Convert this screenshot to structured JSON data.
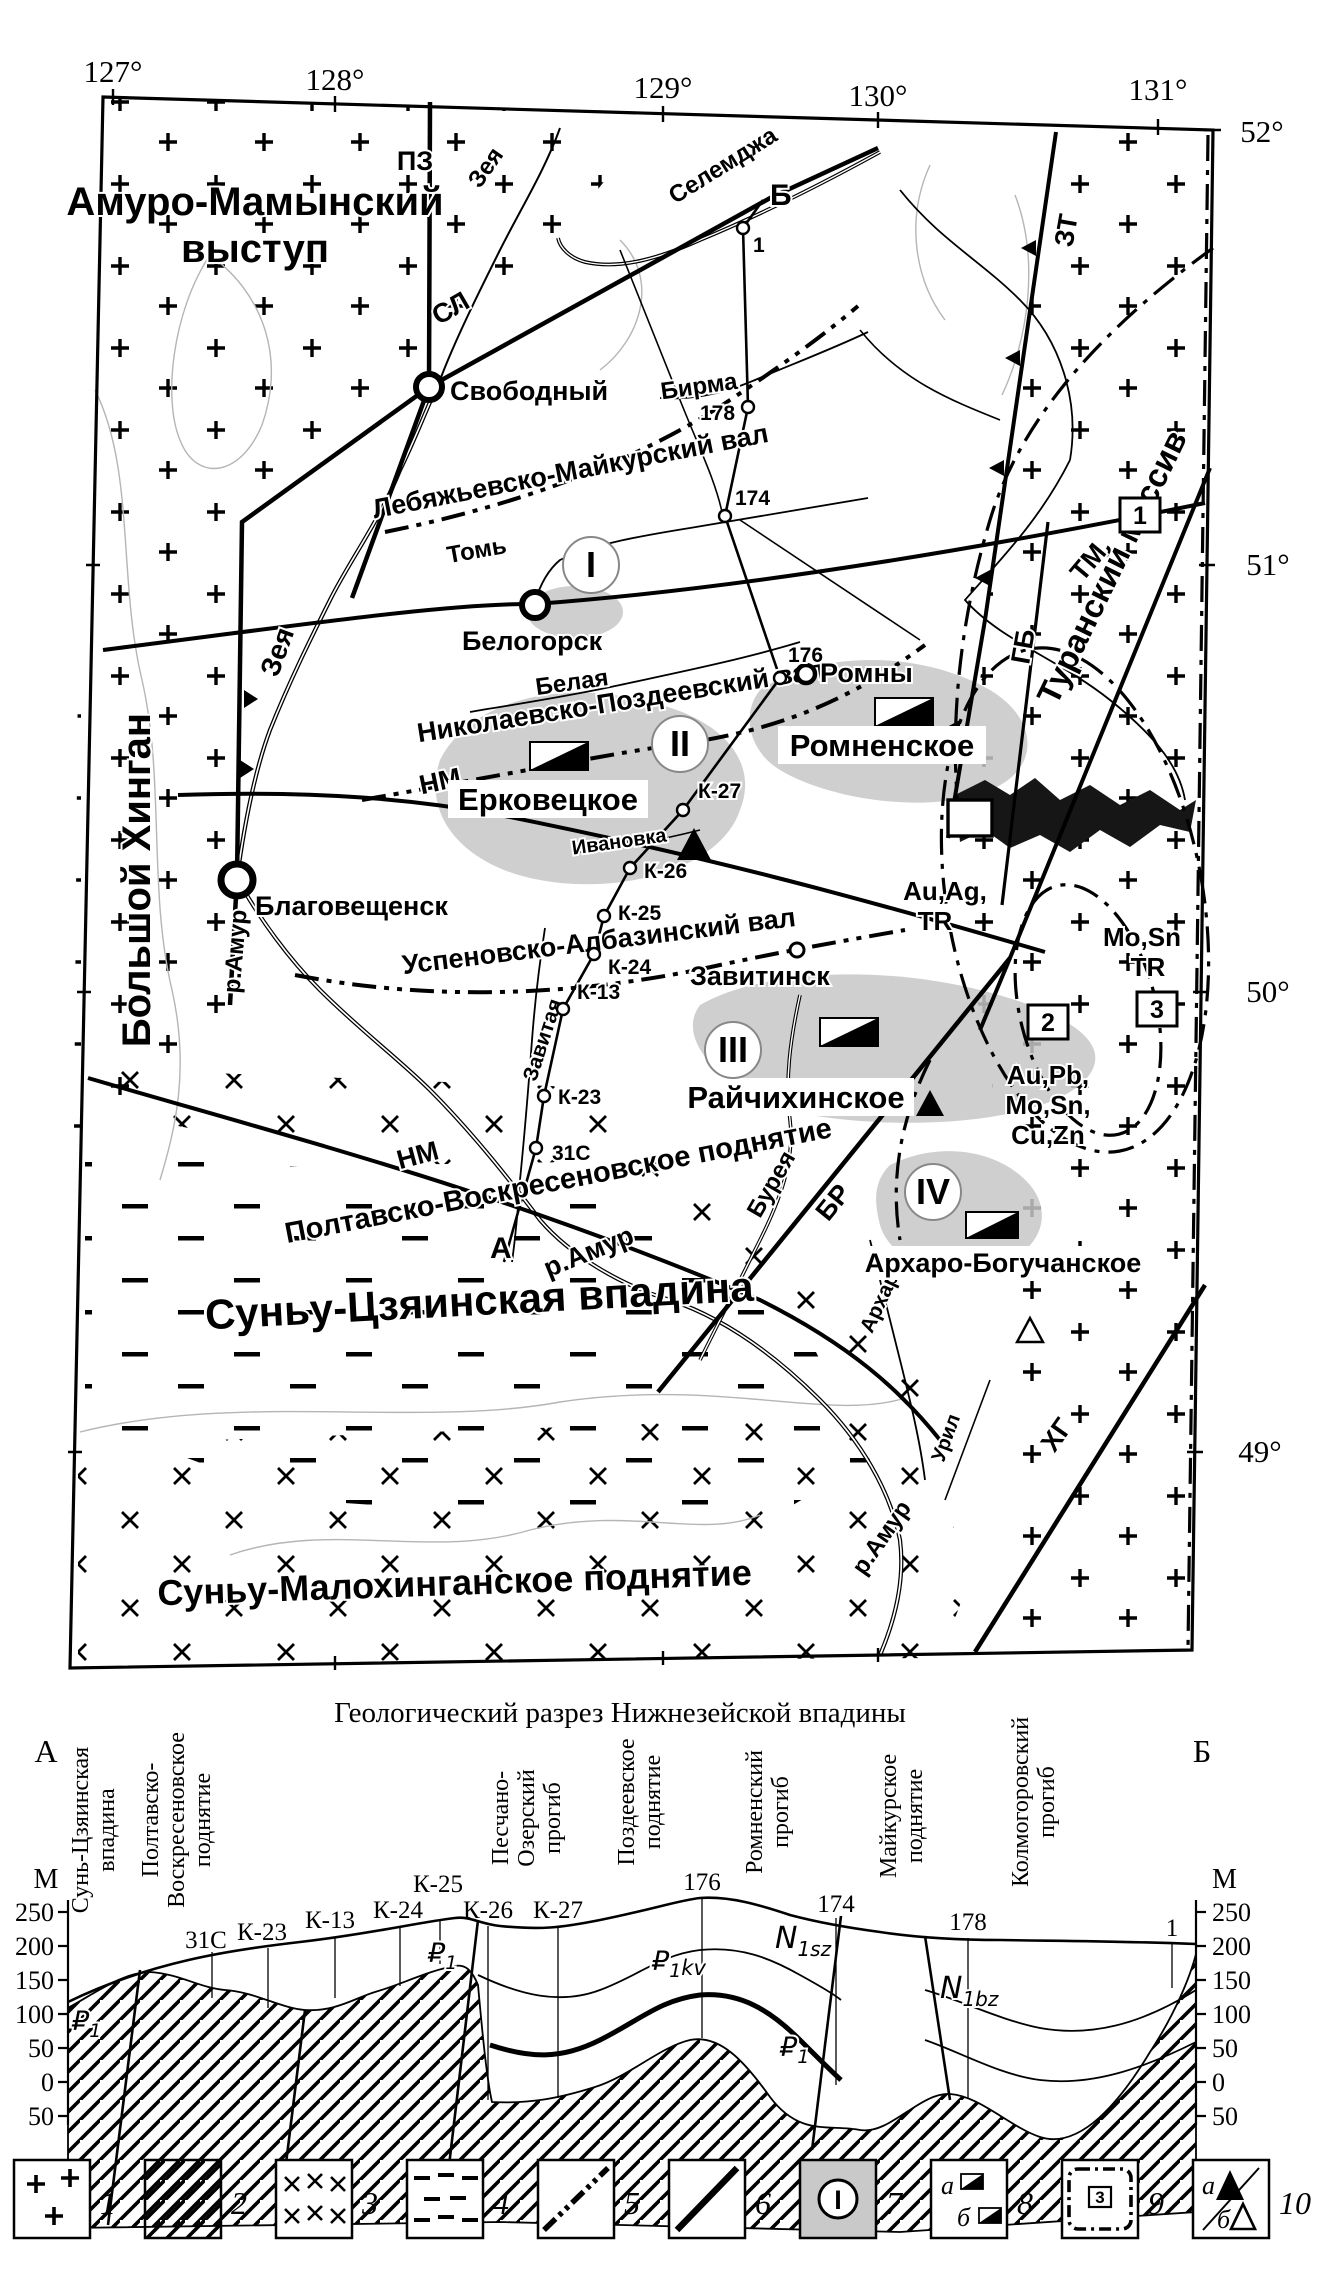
{
  "map": {
    "lon": [
      "127°",
      "128°",
      "129°",
      "130°",
      "131°"
    ],
    "lat": [
      "52°",
      "51°",
      "50°",
      "49°"
    ],
    "units": {
      "amur1": "Амуро-Мамынский",
      "amur2": "выступ",
      "khingan": "Большой Хинган",
      "turan": "Туранский массив",
      "sunyu": "Суньу-Цзяинская впадина",
      "malokhingan": "Суньу-Малохинганское поднятие",
      "poltavsko": "Полтавско-Воскресеновское поднятие"
    },
    "axes": {
      "lebyazhyevsko": "Лебяжьевско-Майкурский вал",
      "nikolaevsko": "Николаевско-Поздеевский вал",
      "uspenovsko": "Успеновско-Албазинский вал"
    },
    "faults": {
      "pz": "ПЗ",
      "sl": "СЛ",
      "zt": "ЗТ",
      "tm": "ТМ",
      "gb": "ГБ",
      "nm1": "НМ",
      "nm2": "НМ",
      "br": "БР",
      "khg": "ХГ"
    },
    "rivers": {
      "zeya1": "Зея",
      "zeya2": "Зея",
      "selemdzha": "Селемджа",
      "birma": "Бирма",
      "tom": "Томь",
      "belaya": "Белая",
      "ivanovka": "Ивановка",
      "zavitaya": "Завитая",
      "bureya": "Бурея",
      "amur1": "р.Амур",
      "amur2": "р.Амур",
      "amur3": "р.Амур",
      "arkhara": "Архара",
      "uril": "Урил"
    },
    "cities": {
      "svobodny": "Свободный",
      "belogorsk": "Белогорск",
      "blagoveshchensk": "Благовещенск",
      "romny": "Ромны",
      "zavitinsk": "Завитинск"
    },
    "deposits": {
      "erkovetskoe": "Ерковецкое",
      "romnenskoe": "Ромненское",
      "raychikhinskoe": "Райчихинское",
      "arkharo": "Архаро-Богучанское"
    },
    "zones": [
      "I",
      "II",
      "III",
      "IV"
    ],
    "boxed": [
      "1",
      "2",
      "3"
    ],
    "minerals": {
      "g1a": "Au,Ag,",
      "g1b": "TR",
      "g2a": "Mo,Sn",
      "g2b": "TR",
      "g3a": "Au,Pb,",
      "g3b": "Mo,Sn,",
      "g3c": "Cu,Zn"
    },
    "pts": {
      "a": "А",
      "b": "Б"
    }
  },
  "boreholes": {
    "b1": "1",
    "b178": "178",
    "b174": "174",
    "b176": "176",
    "k27": "К-27",
    "k26": "К-26",
    "k25": "К-25",
    "k24": "К-24",
    "k13": "К-13",
    "k23": "К-23",
    "s31": "31С"
  },
  "section": {
    "title": "Геологический разрез Нижнезейской впадины",
    "a": "А",
    "b": "Б",
    "m": "М",
    "ticks": [
      "250",
      "200",
      "150",
      "100",
      "50",
      "0",
      "50"
    ],
    "structures": {
      "s1a": "Сунь-Цзяинская",
      "s1b": "впадина",
      "s2a": "Полтавско-",
      "s2b": "Воскресеновское",
      "s2c": "поднятие",
      "s3a": "Песчано-",
      "s3b": "Озерский",
      "s3c": "прогиб",
      "s4a": "Поздеевское",
      "s4b": "поднятие",
      "s5a": "Ромненский",
      "s5b": "прогиб",
      "s6a": "Майкурское",
      "s6b": "поднятие",
      "s7a": "Колмогоровский",
      "s7b": "прогиб"
    },
    "strata": {
      "pl": "₽",
      "pls": "1",
      "pm": "₽",
      "pms": "1",
      "pkv": "₽",
      "pkvs": "1",
      "pkvx": "kv",
      "nsz": "N",
      "nszs": "1sz",
      "nbz": "N",
      "nbzs": "1bz",
      "pb": "₽",
      "pbs": "1"
    }
  },
  "legend": {
    "items": [
      "1",
      "2",
      "3",
      "4",
      "5",
      "6",
      "7",
      "8",
      "9",
      "10"
    ],
    "a": "а",
    "b": "б",
    "box3": "3",
    "zone": "I"
  }
}
